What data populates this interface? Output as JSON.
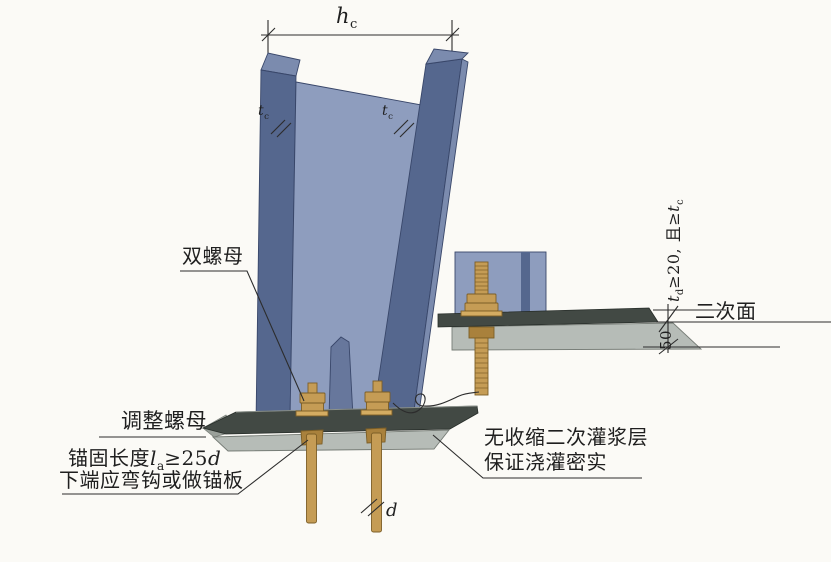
{
  "figure": {
    "type": "structural-detail-diagram",
    "subject": "steel column base with anchor bolts and secondary grouting"
  },
  "colors": {
    "paper": "#fbfaf6",
    "web-blue": "#8e9dbe",
    "flange-blue": "#55678e",
    "flange-top": "#7b8bae",
    "flange-edge": "#39476a",
    "stiffener-blue": "#67779c",
    "plate-dark": "#424944",
    "grout-gray": "#b6bcb7",
    "grout-edge": "#767c76",
    "bolt-gold": "#c59c55",
    "bolt-gold-dark": "#a9813c",
    "bolt-edge": "#7c5e26",
    "line-dark": "#2c2c2c",
    "text": "#1f1f1f"
  },
  "labels": {
    "double_nut": "双螺母",
    "adjust_nut": "调整螺母",
    "anchor_line1": {
      "prefix": "锚固长度",
      "sym": "l",
      "sub": "a",
      "rel": "≥25",
      "dia": "d"
    },
    "anchor_line2": "下端应弯钩或做锚板",
    "grout_line1": "无收缩二次灌浆层",
    "grout_line2": "保证浇灌密实",
    "secondary_surface": "二次面"
  },
  "dimensions": {
    "column_width": {
      "sym": "h",
      "sub": "c"
    },
    "flange_thickness": {
      "sym": "t",
      "sub": "c"
    },
    "plate_thickness": {
      "sym": "t",
      "sub": "d",
      "rel": "≥20, 且≥",
      "sym2": "t",
      "sub2": "c"
    },
    "grout_thickness": "50",
    "bolt_diameter": "d"
  }
}
